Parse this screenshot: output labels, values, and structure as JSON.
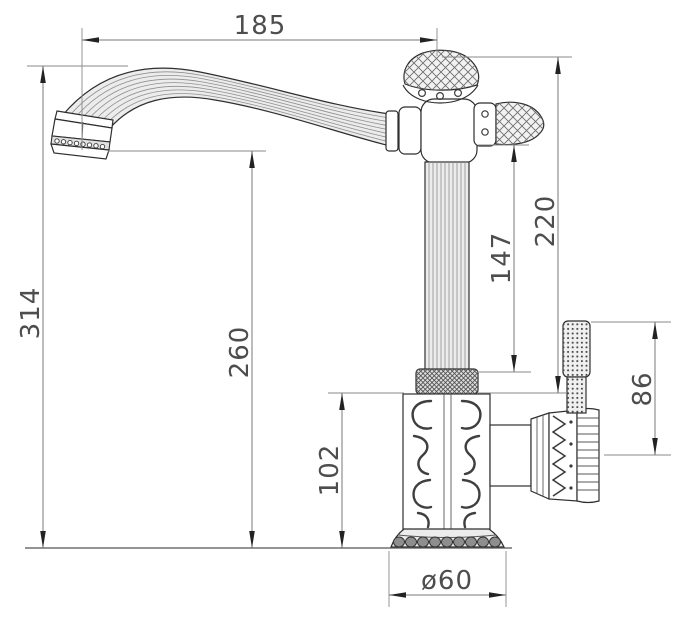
{
  "drawing": {
    "type": "technical-dimension-drawing",
    "subject": "ornate antique-style single-handle faucet, side elevation",
    "colors": {
      "background": "#ffffff",
      "outline": "#2e2e2e",
      "dimension_line": "#7a7a7a",
      "dimension_text": "#4d4d4d",
      "light_fill": "#ececec"
    },
    "dimensions": {
      "spout_reach": "185",
      "overall_height": "314",
      "spout_outlet_height": "260",
      "head_to_base_height": "220",
      "column_height": "147",
      "base_body_height": "102",
      "side_handle_height": "86",
      "base_diameter": "ø60"
    }
  }
}
